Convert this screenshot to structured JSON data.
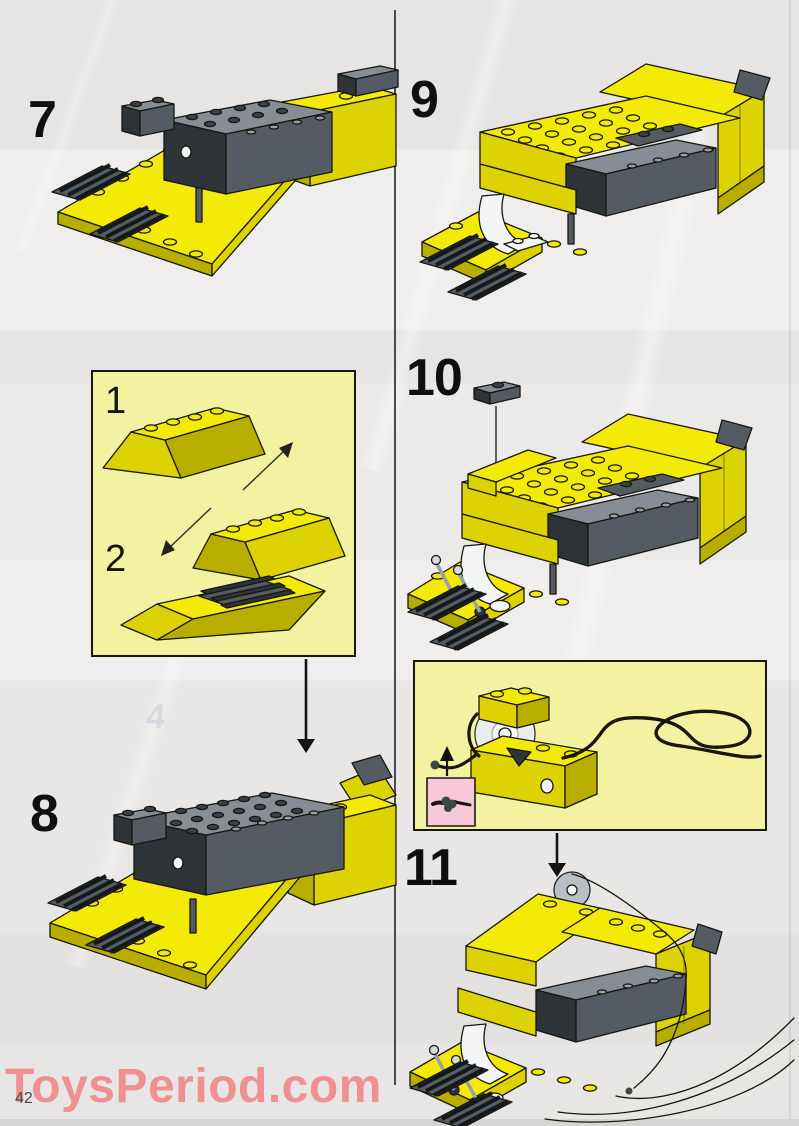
{
  "page": {
    "watermark_text": "ToysPeriod.com",
    "page_number": "42",
    "ghost_digit": "4"
  },
  "steps": {
    "step7": {
      "label": "7"
    },
    "step8": {
      "label": "8"
    },
    "step9": {
      "label": "9"
    },
    "step10": {
      "label": "10"
    },
    "step11": {
      "label": "11"
    }
  },
  "parts_box": {
    "item1_label": "1",
    "item2_label": "2"
  },
  "illustrations": {
    "step7": "yellow-chassis-with-gray-engine-block",
    "step8": "yellow-chassis-with-studded-top-plate-and-spoiler",
    "step9": "car-body-with-stud-deck-and-white-mudguard",
    "step10": "car-body-with-levers-and-floating-plate",
    "step11": "car-body-with-winch-pulley-and-string",
    "parts_box_item1": "two-yellow-slope-bricks-with-swap-arrows",
    "parts_box_item2": "yellow-ramp-with-dark-grille-plate",
    "string_box": "winch-with-pulley-string-loops-and-knot-detail",
    "knot_inset": "knot-close-up-on-pink-background"
  },
  "colors": {
    "lego_yellow": "#f3ea08",
    "lego_yellow_shadow": "#ddd203",
    "lego_yellow_dark": "#b8ae00",
    "part_gray_light": "#878d94",
    "part_gray": "#545b62",
    "part_gray_dark": "#2e3338",
    "white_part": "#f4f6f6",
    "rope": "#3d4844",
    "inset_box_bg": "#f2f2a0",
    "knot_inset_bg": "#f6c8da",
    "watermark": "#ef9191",
    "divider": "#4b4b4b",
    "page_bg": "#e9e8e6"
  }
}
